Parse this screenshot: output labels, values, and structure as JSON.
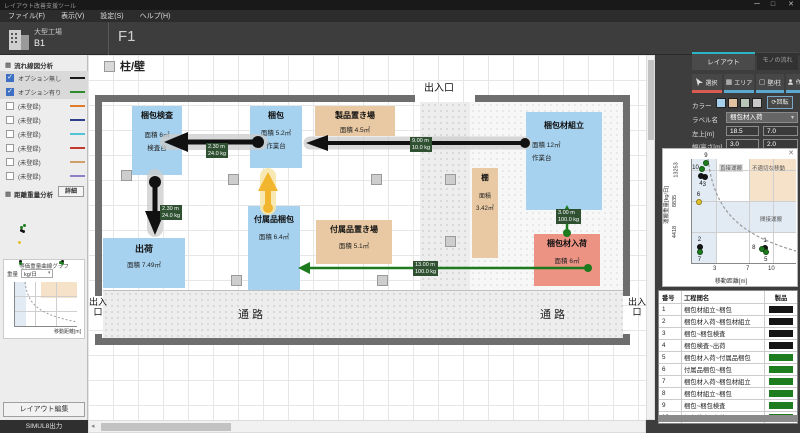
{
  "window": {
    "title": "レイアウト改善支援ツール",
    "minimize": "ー",
    "maximize": "□",
    "close": "✕"
  },
  "menu": {
    "items": [
      "ファイル(F)",
      "表示(V)",
      "設定(S)",
      "ヘルプ(H)"
    ]
  },
  "header": {
    "building_name": "大型工場",
    "building_floor": "B1",
    "floor_label": "F1",
    "zoom_label": "100%",
    "tools": [
      {
        "name": "grid",
        "glyph": "▦"
      },
      {
        "name": "dot-grid",
        "glyph": "▩"
      },
      {
        "name": "text",
        "glyph": "Aa"
      },
      {
        "name": "comment",
        "glyph": "❑"
      },
      {
        "name": "shape",
        "glyph": "◪"
      },
      {
        "name": "line",
        "glyph": "╱"
      },
      {
        "name": "layer",
        "glyph": "▤"
      },
      {
        "name": "triangle",
        "glyph": "◭"
      }
    ]
  },
  "sidebar": {
    "flow_section": {
      "title": "流れ線図分析",
      "items": [
        {
          "label": "オプション無し",
          "checked": true,
          "color": "#1a1a1a"
        },
        {
          "label": "オプション有り",
          "checked": true,
          "color": "#2e8b2e"
        },
        {
          "label": "(未登録)",
          "checked": false,
          "color": "#e07b2a"
        },
        {
          "label": "(未登録)",
          "checked": false,
          "color": "#2b3f8c"
        },
        {
          "label": "(未登録)",
          "checked": false,
          "color": "#53c3d6"
        },
        {
          "label": "(未登録)",
          "checked": false,
          "color": "#c23b2e"
        },
        {
          "label": "(未登録)",
          "checked": false,
          "color": "#cfa06a"
        },
        {
          "label": "(未登録)",
          "checked": false,
          "color": "#9180c8"
        }
      ]
    },
    "weight_section": {
      "title": "距離重量分析",
      "detail_button": "詳細"
    },
    "mini_chart": {
      "title": "等価重量曲線グラフ",
      "unit_label": "重量",
      "unit_value": "kg/日",
      "xlabel": "移動距離[m]"
    },
    "layout_edit_button": "レイアウト編集",
    "simul_button": "SIMUL8出力"
  },
  "canvas": {
    "wall_toggle_label": "柱/壁",
    "entrance_top": "出入口",
    "entrance_bottom_left": "出入口",
    "entrance_bottom_right": "出入口",
    "corridor_left": "通路",
    "corridor_right": "通路",
    "boxes": [
      {
        "title": "梱包検査",
        "line2": "面積 6㎡",
        "line3": "検査台",
        "color": "#a6d2ef"
      },
      {
        "title": "梱包",
        "line2": "面積 5.2㎡",
        "line3": "作業台",
        "color": "#a6d2ef"
      },
      {
        "title": "製品置き場",
        "line2": "面積 4.5㎡",
        "line3": "",
        "color": "#e9c9a3"
      },
      {
        "title": "付属品梱包",
        "line2": "面積 6.4㎡",
        "line3": "",
        "color": "#a6d2ef"
      },
      {
        "title": "付属品置き場",
        "line2": "面積 5.1㎡",
        "line3": "",
        "color": "#e9c9a3"
      },
      {
        "title": "棚",
        "line2": "面積",
        "line3": "3.42㎡",
        "color": "#e9c9a3"
      },
      {
        "title": "梱包材組立",
        "line2": "面積 12㎡",
        "line3": "作業台",
        "color": "#a6d2ef"
      },
      {
        "title": "梱包材入荷",
        "line2": "面積 6㎡",
        "line3": "",
        "color": "#ec9384"
      },
      {
        "title": "出荷",
        "line2": "面積 7.49㎡",
        "line3": "",
        "color": "#a6d2ef"
      }
    ],
    "arrow_labels": [
      {
        "dist": "2.30 m",
        "weight": "24.0 kg"
      },
      {
        "dist": "2.30 m",
        "weight": "24.0 kg"
      },
      {
        "dist": "9.00 m",
        "weight": "10.0 kg"
      },
      {
        "dist": "13.00 m",
        "weight": "100.0 kg"
      },
      {
        "dist": "3.00 m",
        "weight": "100.0 kg"
      }
    ]
  },
  "panel": {
    "tabs": [
      {
        "label": "レイアウト"
      },
      {
        "label": "モノの流れ"
      }
    ],
    "tools": [
      {
        "label": "選択"
      },
      {
        "label": "エリア"
      },
      {
        "label": "壁/柱"
      },
      {
        "label": "作業者"
      }
    ],
    "color_label": "カラー",
    "swatches": [
      "#a8d0ec",
      "#e3c2a2",
      "#b9c7b9",
      "#c9c9c9"
    ],
    "rotate_button": "回転",
    "fields": {
      "label_name": "ラベル名",
      "label_value": "梱包材入荷",
      "pos_label": "左上[m]",
      "pos_x": "18.5",
      "pos_y": "7.0",
      "size_label": "幅/高さ[m]",
      "size_w": "3.0",
      "size_h": "2.0"
    }
  },
  "chart_data": {
    "type": "scatter",
    "title": "距離重量分析",
    "xlabel": "移動距離[m]",
    "ylabel": "運搬重量[kg/日]",
    "x_ticks": [
      3,
      7,
      10
    ],
    "y_ticks": [
      4418,
      8835,
      13253
    ],
    "xlim": [
      0,
      12
    ],
    "ylim": [
      0,
      14700
    ],
    "region_labels": {
      "direct": "直接運搬",
      "improper": "不適切な移動",
      "indirect": "間接運搬"
    },
    "points": [
      {
        "id": 1,
        "x": 9.3,
        "y": 2000,
        "color": "black",
        "label_pos": "above"
      },
      {
        "id": 2,
        "x": 1.2,
        "y": 2100,
        "color": "black",
        "label_pos": "above"
      },
      {
        "id": 3,
        "x": 1.8,
        "y": 12100,
        "color": "black",
        "label_pos": "below"
      },
      {
        "id": 4,
        "x": 1.4,
        "y": 12150,
        "color": "black",
        "label_pos": "below"
      },
      {
        "id": 5,
        "x": 9.4,
        "y": 1350,
        "color": "green",
        "label_pos": "below"
      },
      {
        "id": 6,
        "x": 1.1,
        "y": 8500,
        "color": "yellow",
        "label_pos": "above"
      },
      {
        "id": 7,
        "x": 1.2,
        "y": 1350,
        "color": "green",
        "label_pos": "below"
      },
      {
        "id": 8,
        "x": 8.9,
        "y": 1900,
        "color": "green",
        "label_pos": "left"
      },
      {
        "id": 9,
        "x": 2.0,
        "y": 14000,
        "color": "green",
        "label_pos": "above"
      },
      {
        "id": 10,
        "x": 1.5,
        "y": 13253,
        "color": "green",
        "label_pos": "left"
      }
    ]
  },
  "table": {
    "headers": [
      "番号",
      "工程間名",
      "製品"
    ],
    "rows": [
      {
        "no": "1",
        "name": "梱包材組立~梱包",
        "color": "#151515"
      },
      {
        "no": "2",
        "name": "梱包材入荷~梱包材組立",
        "color": "#151515"
      },
      {
        "no": "3",
        "name": "梱包~梱包検査",
        "color": "#151515"
      },
      {
        "no": "4",
        "name": "梱包検査~出荷",
        "color": "#151515"
      },
      {
        "no": "5",
        "name": "梱包材入荷~付属品梱包",
        "color": "#1e7d1e"
      },
      {
        "no": "6",
        "name": "付属品梱包~梱包",
        "color": "#1e7d1e"
      },
      {
        "no": "7",
        "name": "梱包材入荷~梱包材組立",
        "color": "#1e7d1e"
      },
      {
        "no": "8",
        "name": "梱包材組立~梱包",
        "color": "#1e7d1e"
      },
      {
        "no": "9",
        "name": "梱包~梱包検査",
        "color": "#1e7d1e"
      },
      {
        "no": "10",
        "name": "梱包検査~出荷",
        "color": "#1e7d1e"
      }
    ]
  }
}
